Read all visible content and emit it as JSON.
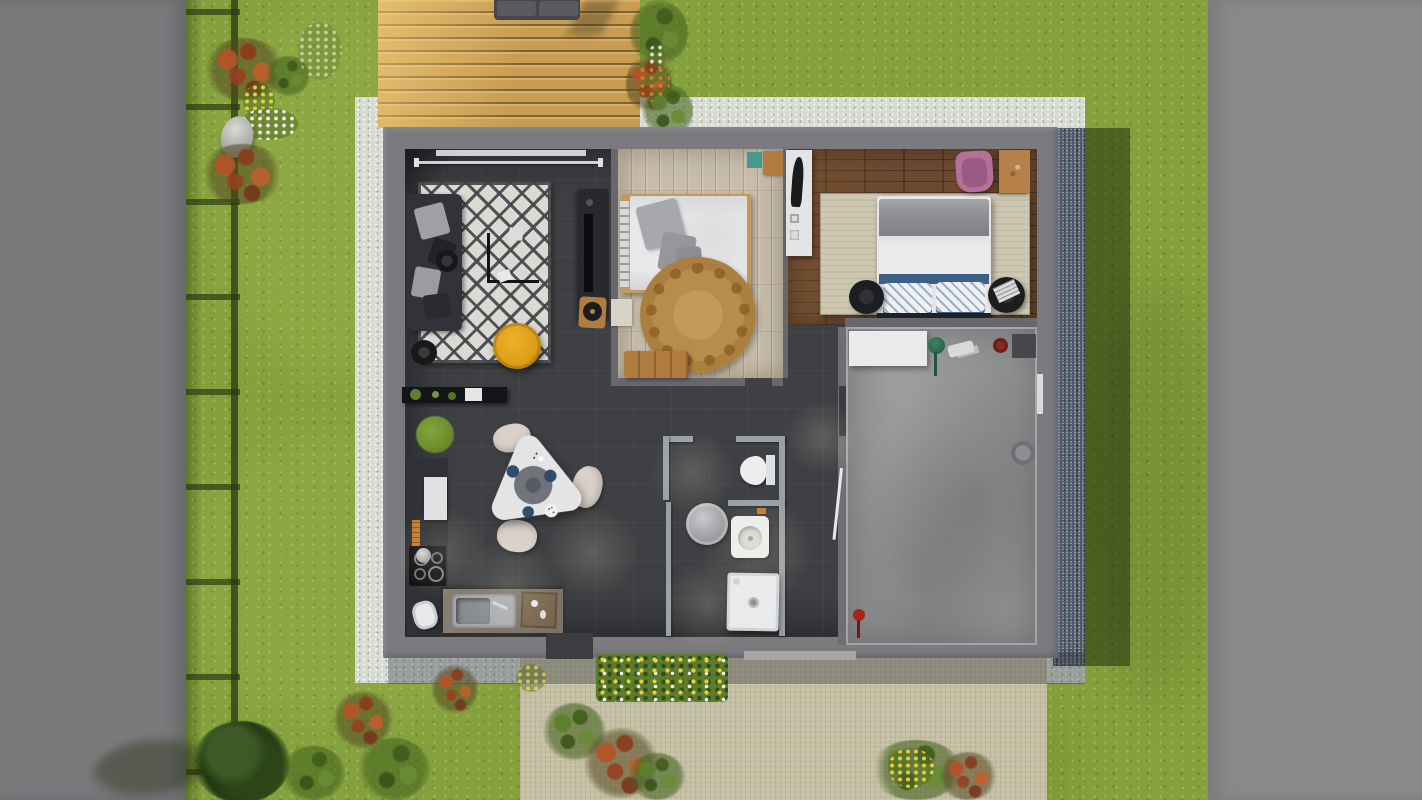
{
  "scene": {
    "type": "top-down 3d render of a single-storey house floor plan with garden",
    "outdoor": [
      "lawn",
      "left boundary wall",
      "right boundary wall",
      "fence shadow",
      "wood deck with sofa",
      "white gravel apron",
      "blue gravel drain strip",
      "beige paved path",
      "flower beds",
      "bushes",
      "stone"
    ],
    "rooms": [
      "living room",
      "bedroom 1",
      "bedroom 2",
      "kitchen dining",
      "bathroom",
      "wc",
      "garage"
    ],
    "living_room": [
      "diamond pattern rug",
      "dark sofa with cushions",
      "coffee table",
      "yellow pouf",
      "black side table",
      "tv console",
      "vinyl stool",
      "curtain rod",
      "window sill"
    ],
    "bedroom_1": [
      "double bed white duvet",
      "gray pillows",
      "round jute rug",
      "wood bench",
      "nightstand",
      "teal box",
      "wood dresser"
    ],
    "bedroom_2": [
      "bed with gray blanket and blue pillows",
      "round black nightstands",
      "beige area rug",
      "pink chair",
      "wood desk",
      "white wardrobe with mirror"
    ],
    "kitchen": [
      "wall shelf",
      "fridge cabinet",
      "cooktop",
      "sink counter",
      "cutting board",
      "trash bin",
      "triangular dining table",
      "lazy susan",
      "blue plates",
      "three chairs",
      "moss plant"
    ],
    "bathroom": [
      "toilet",
      "washbasin",
      "shower tray",
      "round washing machine top",
      "partition walls"
    ],
    "garage": [
      "concrete floor",
      "white workbench",
      "watering can",
      "bucket",
      "floor mat",
      "red tools"
    ]
  },
  "colors": {
    "grass_base": "#85a13d",
    "boundary_wall_left": "#7a7a7d",
    "boundary_wall_right": "#8a8a8d",
    "fence_shadow": "#2e3a16",
    "deck_wood": "#c89c51",
    "deck_sofa": "#46474c",
    "gravel_white": "#d8dbd2",
    "gravel_blue": "#4e5764",
    "grass_shadow": "#28380e",
    "house_wall": "#7b7b7f",
    "floor_dark": "#3e4043",
    "wood_light": "#c7bdaa",
    "wood_dark": "#6b4a31",
    "concrete": "#8f9092",
    "rug_living_bg": "#dad9d4",
    "rug_living_pattern": "#4a4c4e",
    "rug_jute": "#b88d4b",
    "rug_beige": "#cec7b2",
    "sofa_dark": "#323338",
    "pouf_yellow": "#dfa018",
    "tv_console": "#28292d",
    "table_white": "#e4e4e6",
    "chair_beige": "#d9d0c9",
    "plate_blue": "#2f4d6b",
    "bed_white": "#e9e9eb",
    "pillow_gray": "#a0a1a5",
    "blanket_gray": "#8f9195",
    "pillow_blue": "#3e5f88",
    "chair_pink": "#b4709b",
    "chair_pink_seat": "#9a5a84",
    "wood_furniture": "#b07c3f",
    "bath_wall": "#9ba0a6",
    "fixture_white": "#eceded",
    "washer_silver": "#b0b1b5",
    "path_beige": "#c4bea3",
    "counter_black": "#141518",
    "counter_dark": "#313236",
    "cooktop_black": "#101114",
    "steel": "#a9acb1",
    "accent_red": "#a82318",
    "accent_dark_red": "#6e2016",
    "plant_green": "#5f8030",
    "moss_green": "#6f8f2e",
    "teal_item": "#48998c",
    "flower_yellow": "#e9cf3a",
    "flower_white": "#f2f3ee",
    "flower_rust": "#b2542a",
    "stone_gray": "#b9b9b4"
  }
}
